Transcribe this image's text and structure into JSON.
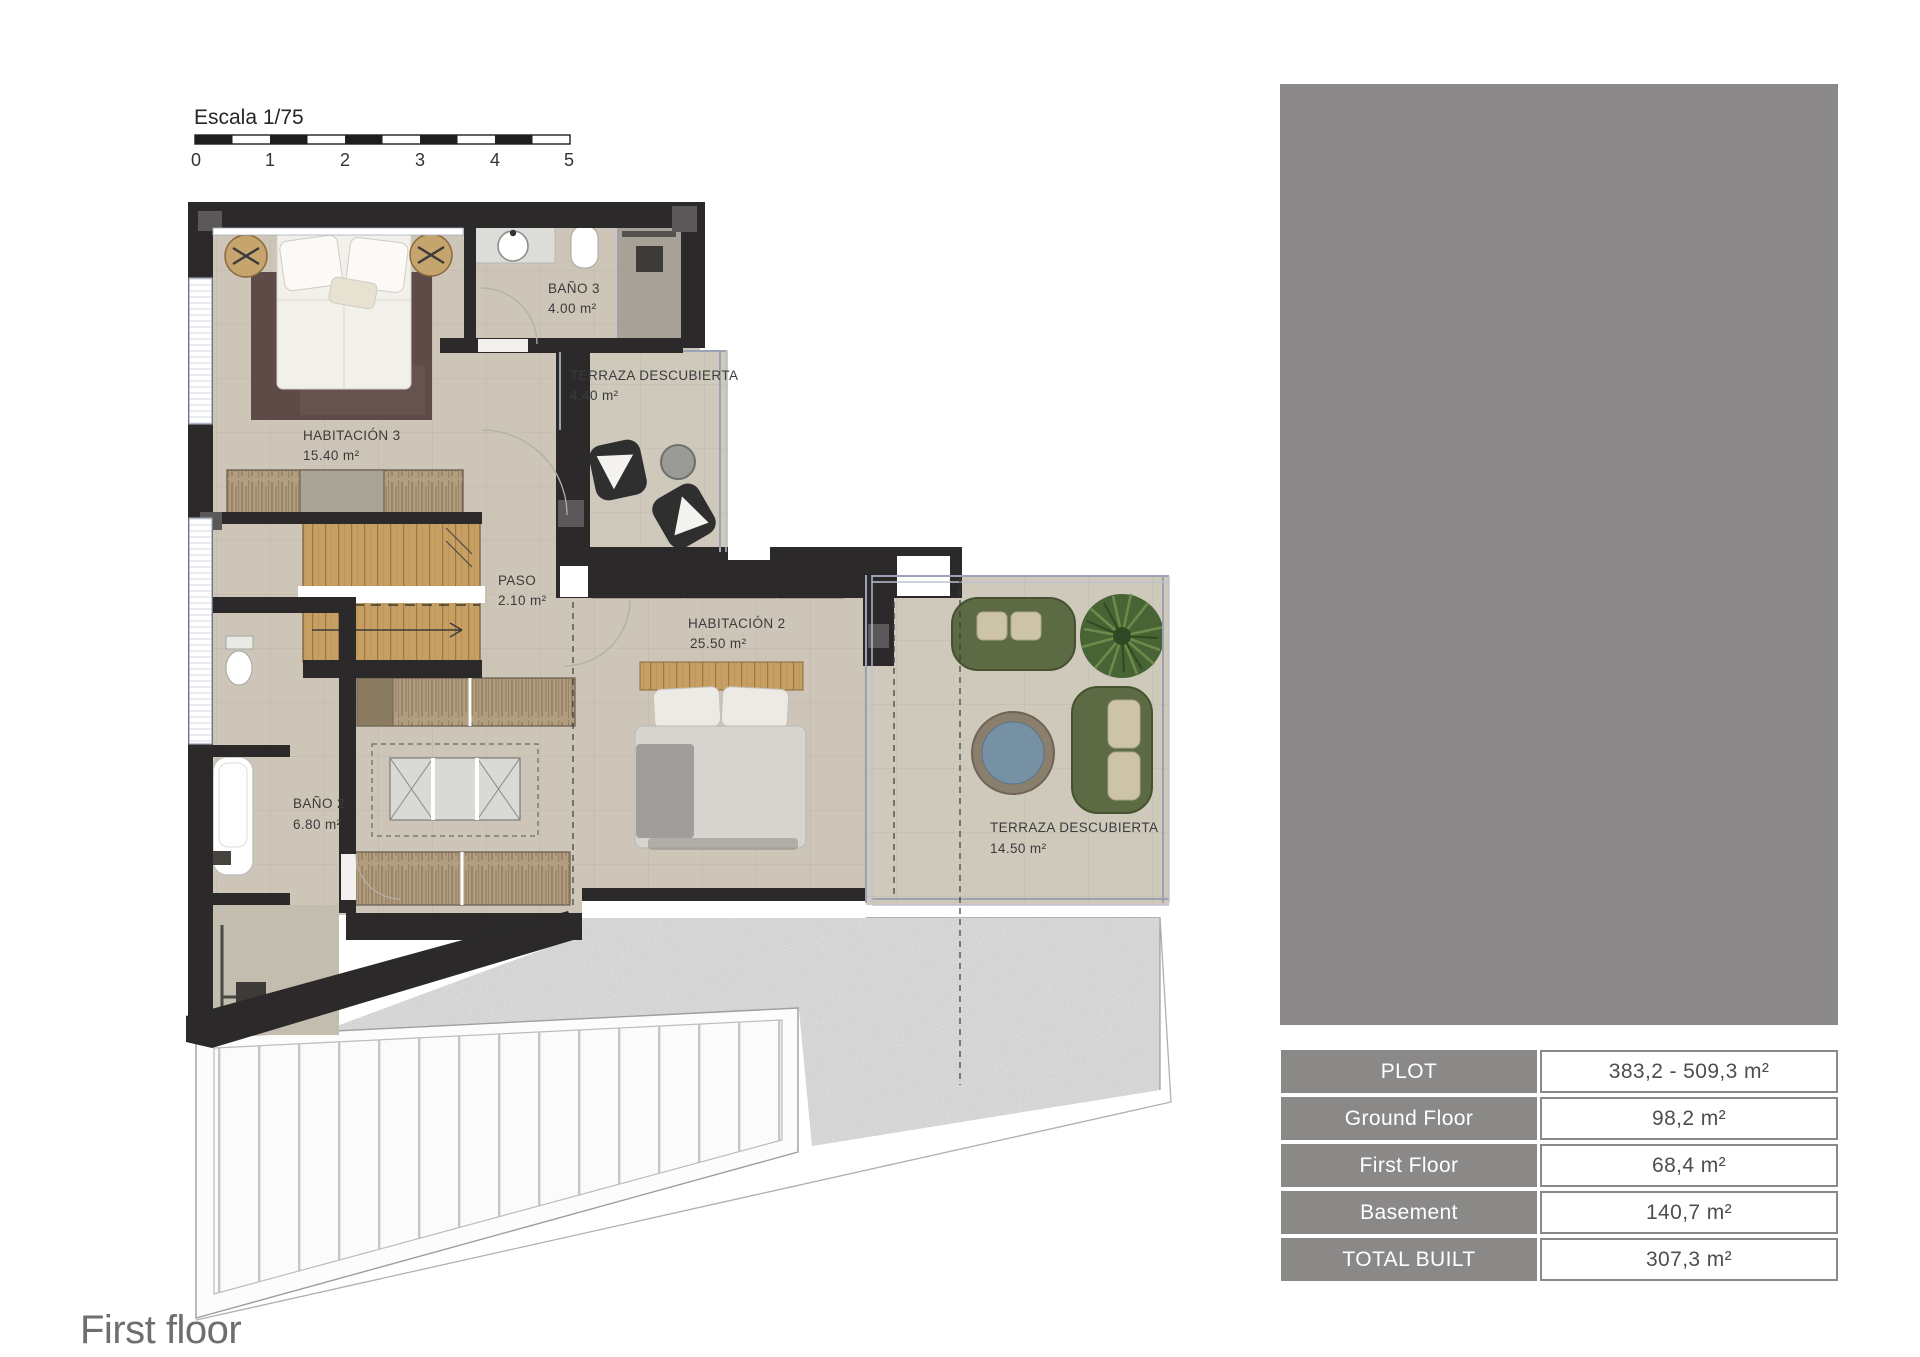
{
  "scale_bar": {
    "label": "Escala 1/75",
    "ticks": [
      "0",
      "1",
      "2",
      "3",
      "4",
      "5"
    ]
  },
  "floor_label": "First floor",
  "rooms": [
    {
      "name": "HABITACIÓN 3",
      "area": "15.40 m²"
    },
    {
      "name": "BAÑO 3",
      "area": "4.00 m²"
    },
    {
      "name": "TERRAZA DESCUBIERTA",
      "area": "4.40 m²"
    },
    {
      "name": "PASO",
      "area": "2.10 m²"
    },
    {
      "name": "HABITACIÓN 2",
      "area": "25.50 m²"
    },
    {
      "name": "BAÑO 2",
      "area": "6.80 m²"
    },
    {
      "name": "TERRAZA DESCUBIERTA",
      "area": "14.50 m²"
    }
  ],
  "summary_table": {
    "rows": [
      {
        "label": "PLOT",
        "value": "383,2 - 509,3 m²"
      },
      {
        "label": "Ground Floor",
        "value": "98,2 m²"
      },
      {
        "label": "First Floor",
        "value": "68,4 m²"
      },
      {
        "label": "Basement",
        "value": "140,7 m²"
      },
      {
        "label": "TOTAL BUILT",
        "value": "307,3 m²"
      }
    ]
  },
  "colors": {
    "wall": "#2b2929",
    "floor_tile": "#ccc5b8",
    "terrace_tile": "#cfc9bc",
    "wood": "#c9a265",
    "sofa_green": "#5d6b44",
    "table_blue": "#7791a4",
    "plant_green": "#486334",
    "placeholder_gray": "#8b8989",
    "table_header_gray": "#8b8888",
    "glass_rail": "#9aa2b4",
    "label_text": "#3b3b3b"
  }
}
